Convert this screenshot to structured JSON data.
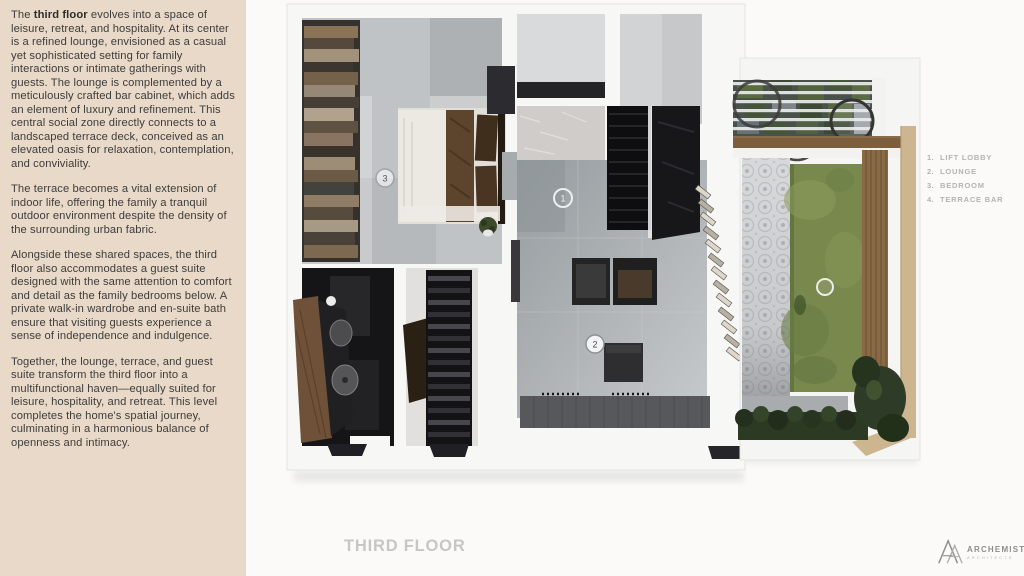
{
  "panel": {
    "p1_before": "The ",
    "p1_bold": "third floor",
    "p1_after": " evolves into a space of leisure, retreat, and hospitality. At its center is a refined lounge, envisioned as a casual yet sophisticated setting for family interactions or intimate gatherings with guests. The lounge is complemented by a meticulously crafted bar cabinet, which adds an element of luxury and refinement. This central social zone directly connects to a landscaped terrace deck, conceived as an elevated oasis for relaxation, contemplation, and conviviality.",
    "p2": "The terrace becomes a vital extension of indoor life, offering the family a tranquil outdoor environment despite the density of the surrounding urban fabric.",
    "p3": "Alongside these shared spaces, the third floor also accommodates a guest suite designed with the same attention to comfort and detail as the family bedrooms below. A private walk-in wardrobe and en-suite bath ensure that visiting guests experience a sense of independence and indulgence.",
    "p4": "Together, the lounge, terrace, and guest suite transform the third floor into a multifunctional haven—equally suited for leisure, hospitality, and retreat. This level completes the home's spatial journey, culminating in a harmonious balance of openness and intimacy."
  },
  "plan": {
    "floor_label": "THIRD FLOOR",
    "markers": {
      "m1": "1",
      "m2": "2",
      "m3": "3",
      "m4": ""
    },
    "legend": {
      "items": [
        {
          "num": "1.",
          "label": "LIFT LOBBY"
        },
        {
          "num": "2.",
          "label": "LOUNGE"
        },
        {
          "num": "3.",
          "label": "BEDROOM"
        },
        {
          "num": "4.",
          "label": "TERRACE BAR"
        }
      ]
    }
  },
  "logo": {
    "name": "ARCHEMIST",
    "sub": "ARCHITECTS"
  },
  "colors": {
    "panel_bg": "#e8d9c9",
    "text_dark": "#3e3d3b",
    "title_gray": "#c7c6c5",
    "legend_gray": "#b5b3b0",
    "floor_gray": "#b0b4b7",
    "stair_black": "#0e0e10",
    "lawn_green": "#79894d",
    "deck_wood": "#8a6a45",
    "hedge_green": "#2c3a24",
    "marble": "#cfccc9",
    "wall_white": "#f7f7f6"
  }
}
